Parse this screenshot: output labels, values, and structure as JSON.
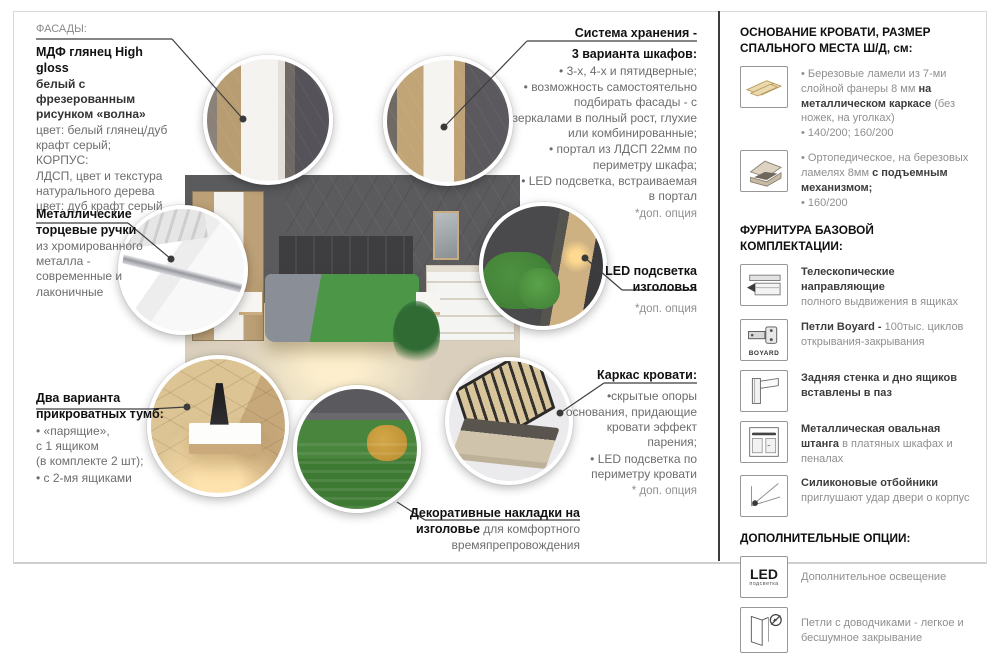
{
  "callouts": {
    "facades": {
      "label": "ФАСАДЫ:",
      "title": "МДФ глянец High gloss",
      "subtitle": "белый с фрезерованным рисунком «волна»",
      "line1": "цвет: белый глянец/дуб крафт серый;",
      "line2": "КОРПУС:",
      "line3": "ЛДСП, цвет и текстура натурального дерева",
      "line4": "цвет: дуб крафт серый"
    },
    "handles": {
      "title": "Металлические торцевые ручки",
      "body": "из хромированного металла - современные и лаконичные"
    },
    "nightstands": {
      "title": "Два варианта прикроватных тумб:",
      "bullet1": "• «парящие»,\nс 1 ящиком\n(в комплекте 2 шт);",
      "bullet2": "• с 2-мя ящиками"
    },
    "storage": {
      "title_line1": "Система хранения -",
      "title_line2": "3 варианта шкафов:",
      "bullet1": "• 3-х, 4-х и пятидверные;",
      "bullet2": "• возможность самостоятельно подбирать фасады - с зеркалами в полный рост, глухие или комбинированные;",
      "bullet3": "• портал из ЛДСП 22мм по периметру шкафа;",
      "bullet4": "• LED подсветка, встраиваемая в портал",
      "footnote": "*доп. опция"
    },
    "led": {
      "title_line1": "LED подсветка",
      "title_line2": "изголовья",
      "footnote": "*доп. опция"
    },
    "bed_frame": {
      "title": "Каркас кровати:",
      "bullet1": "•скрытые опоры основания, придающие кровати эффект парения;",
      "bullet2": "• LED подсветка по периметру кровати",
      "footnote": "* доп. опция"
    },
    "decor": {
      "bold": "Декоративные накладки на изголовье",
      "rest": " для комфортного времяпрепровождения"
    }
  },
  "right_panel": {
    "base_section": {
      "title": "ОСНОВАНИЕ КРОВАТИ, РАЗМЕР СПАЛЬНОГО МЕСТА Ш/Д, см:",
      "item1": {
        "icon": "slatted-base-icon",
        "b1_pre": "• Березовые ламели из 7-ми слойной фанеры 8 мм ",
        "b1_bold": "на металлическом каркасе",
        "b1_post": " (без ножек, на уголках)",
        "b2": "• 140/200; 160/200"
      },
      "item2": {
        "icon": "lift-bed-icon",
        "b1_pre": "• Ортопедическое, на березовых ламелях 8мм ",
        "b1_bold": "с подъемным механизмом;",
        "b1_post": "",
        "b2": "• 160/200"
      }
    },
    "hardware_section": {
      "title": "ФУРНИТУРА БАЗОВОЙ КОМПЛЕКТАЦИИ:",
      "item1": {
        "icon": "drawer-slides-icon",
        "bold": "Телескопические направляющие",
        "gray": "полного выдвижения в ящиках"
      },
      "item2": {
        "icon": "hinge-boyard-icon",
        "icon_label": "BOYARD",
        "bold": "Петли Boyard - ",
        "gray": "100тыс. циклов открывания-закрывания"
      },
      "item3": {
        "icon": "groove-panel-icon",
        "bold": "Задняя стенка и дно ящиков вставлены в паз",
        "gray": ""
      },
      "item4": {
        "icon": "oval-rail-icon",
        "bold": "Металлическая овальная штанга",
        "gray": " в платяных шкафах и пеналах"
      },
      "item5": {
        "icon": "silicone-damper-icon",
        "bold": "Силиконовые отбойники",
        "gray": "приглушают удар двери о корпус"
      }
    },
    "options_section": {
      "title": "ДОПОЛНИТЕЛЬНЫЕ ОПЦИИ:",
      "item1": {
        "icon": "led-light-icon",
        "icon_text": "LED",
        "icon_sub": "подсветка",
        "text": "Дополнительное освещение"
      },
      "item2": {
        "icon": "soft-close-icon",
        "text": "Петли с доводчиками - легкое и бесшумное закрывание"
      }
    }
  }
}
